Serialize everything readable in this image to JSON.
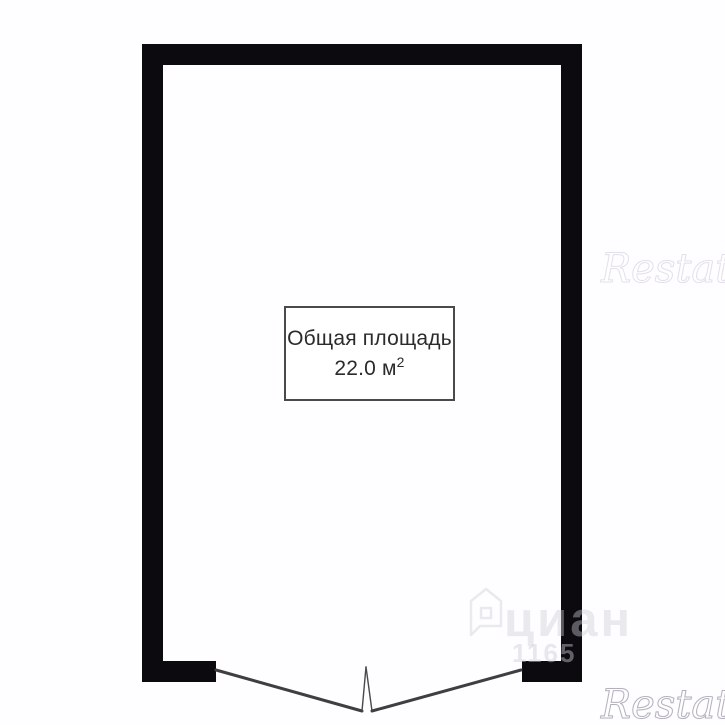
{
  "floorplan": {
    "label_box": {
      "title": "Общая площадь",
      "area_value": "22.0 м",
      "area_sup": "2"
    },
    "watermarks": {
      "restate": "Restate",
      "cian_text": "циан",
      "cian_number": "1165"
    },
    "colors": {
      "wall": "#0c0a0e",
      "door_line": "#3f3f3f",
      "label_border": "#4a4a4a",
      "label_text": "#2b2b2b",
      "watermark_gray": "#cdcdd6",
      "background": "#fefdff"
    }
  }
}
